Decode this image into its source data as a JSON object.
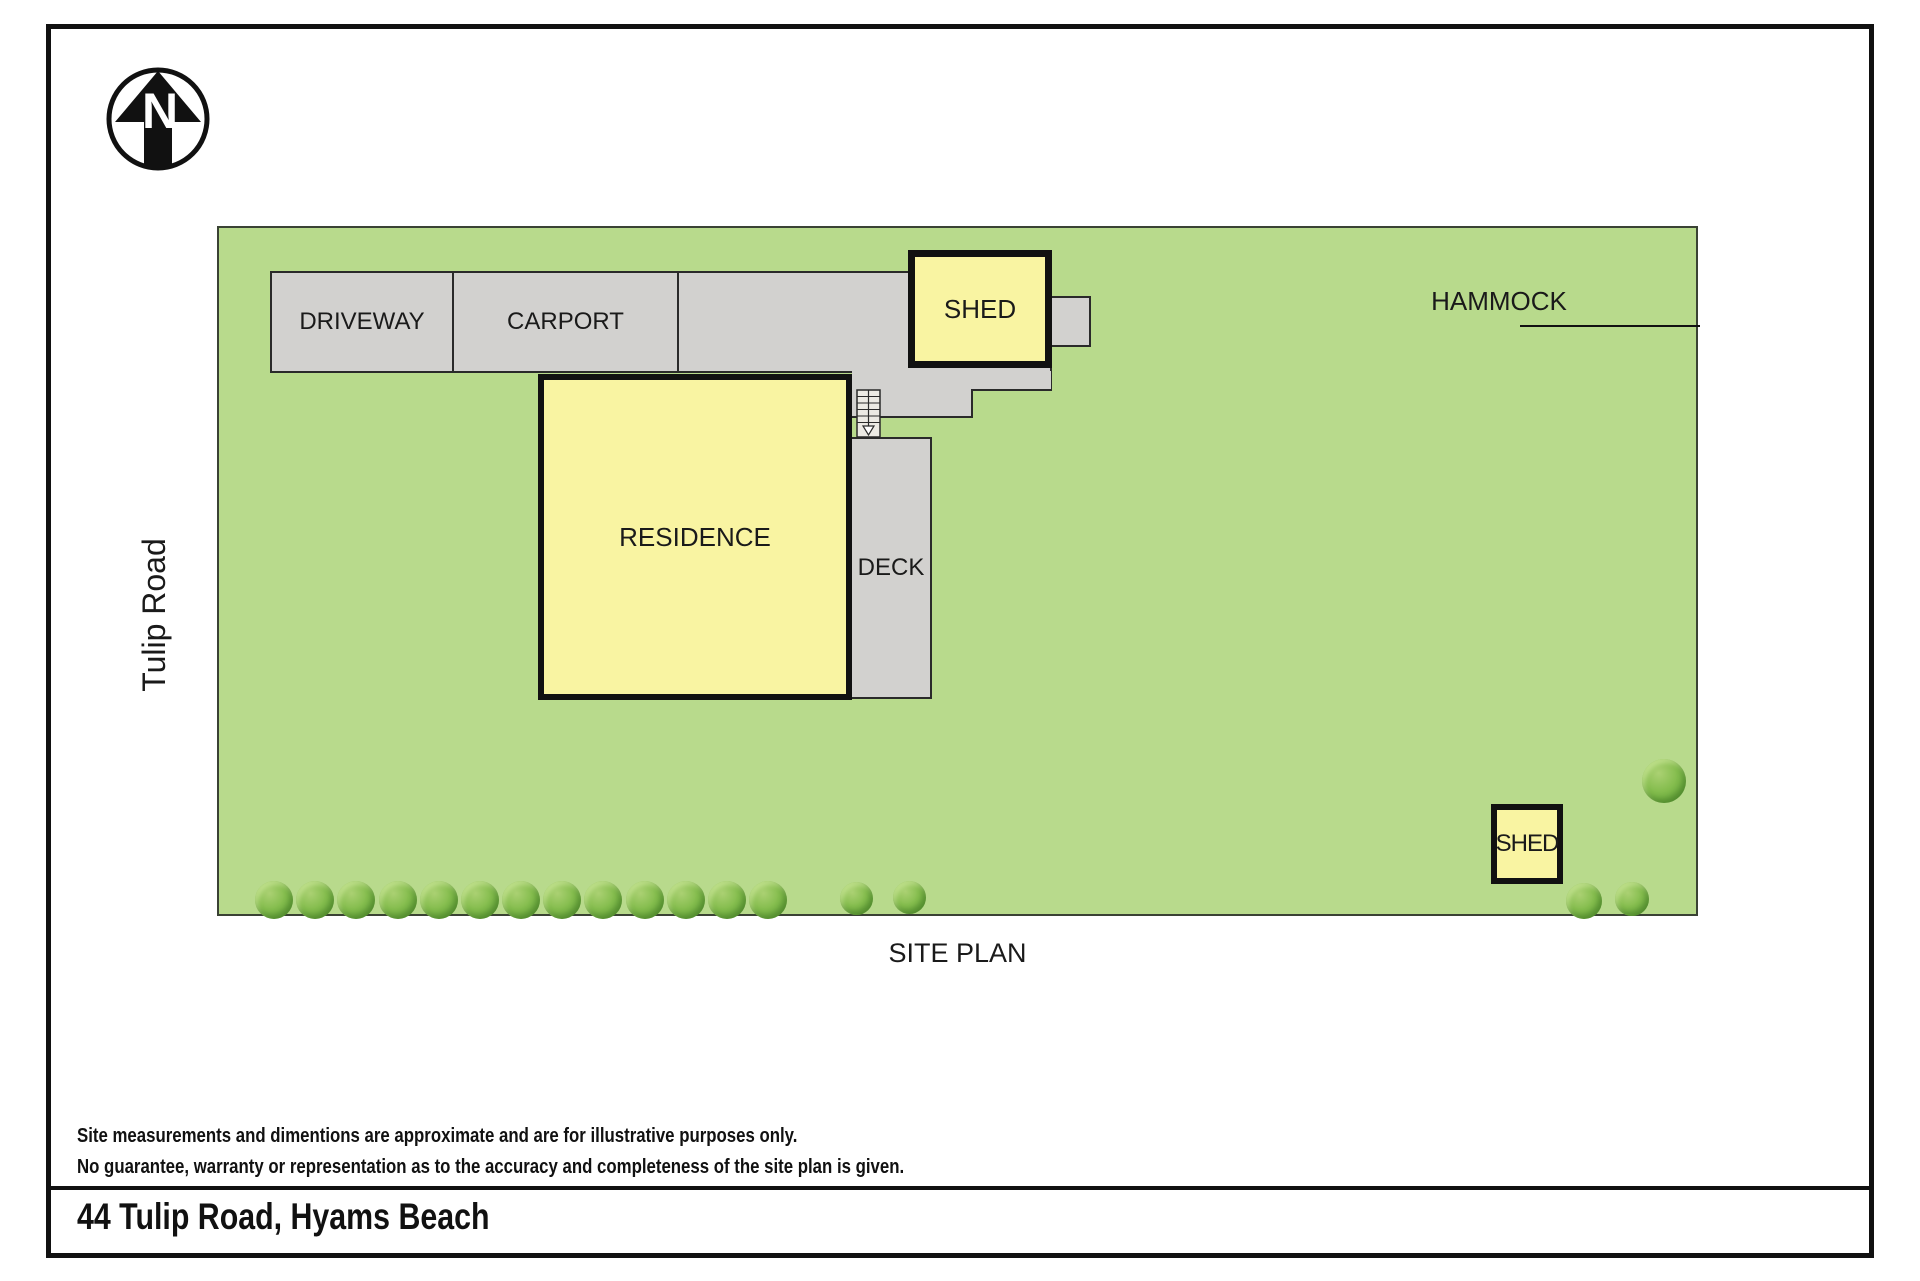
{
  "compass": {
    "label": "N"
  },
  "road": {
    "label": "Tulip Road"
  },
  "areas": {
    "driveway": "DRIVEWAY",
    "carport": "CARPORT",
    "residence": "RESIDENCE",
    "deck": "DECK",
    "shed_top": "SHED",
    "shed_bottom": "SHED",
    "hammock": "HAMMOCK"
  },
  "caption": "SITE PLAN",
  "disclaimer": {
    "line1": "Site measurements and dimentions are approximate and are for illustrative purposes only.",
    "line2": "No guarantee, warranty or representation as to the accuracy and completeness of the site plan is given."
  },
  "address": "44 Tulip Road, Hyams Beach",
  "colors": {
    "grass": "#b8da8c",
    "paving": "#d2d1cf",
    "building": "#f9f4a2",
    "outline": "#111111",
    "tree": "#7ab648"
  },
  "trees": {
    "bottom_row_count": 13,
    "extra_bottom_count": 2,
    "right_cluster_count": 3
  }
}
